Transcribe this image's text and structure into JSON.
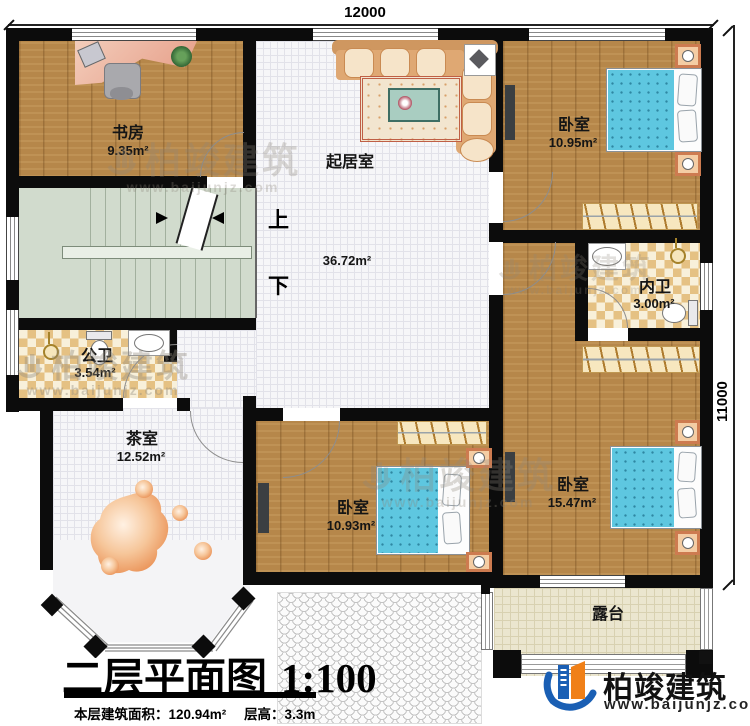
{
  "plan": {
    "dim_top": "12000",
    "dim_right": "11000",
    "stair_up": "上",
    "stair_down": "下",
    "rooms": {
      "study": {
        "name": "书房",
        "area": "9.35m²"
      },
      "living": {
        "name": "起居室",
        "area": "36.72m²"
      },
      "bedroom_top": {
        "name": "卧室",
        "area": "10.95m²"
      },
      "bath_inner": {
        "name": "内卫",
        "area": "3.00m²"
      },
      "bath_public": {
        "name": "公卫",
        "area": "3.54m²"
      },
      "tea_room": {
        "name": "茶室",
        "area": "12.52m²"
      },
      "bedroom_mid": {
        "name": "卧室",
        "area": "10.93m²"
      },
      "bedroom_right": {
        "name": "卧室",
        "area": "15.47m²"
      },
      "terrace": {
        "name": "露台"
      }
    }
  },
  "title": {
    "main": "二层平面图",
    "scale": "1:100",
    "info_area": "本层建筑面积：120.94m²",
    "info_height": "层高：3.3m"
  },
  "brand": {
    "name": "柏竣建筑",
    "url": "www.baijunjz.com"
  },
  "watermark": {
    "name": "柏竣建筑",
    "url": "www.baijunjz.com"
  },
  "colors": {
    "wall": "#0c0c0c",
    "wood_floor": "#b6874a",
    "stair_floor": "#d1dbcd",
    "bath_tile": "#e5c183",
    "terrace_floor": "#ebe6cf",
    "bed_blue": "#5ec7e0",
    "brand_blue": "#1a5fb4",
    "brand_orange": "#f08018"
  }
}
